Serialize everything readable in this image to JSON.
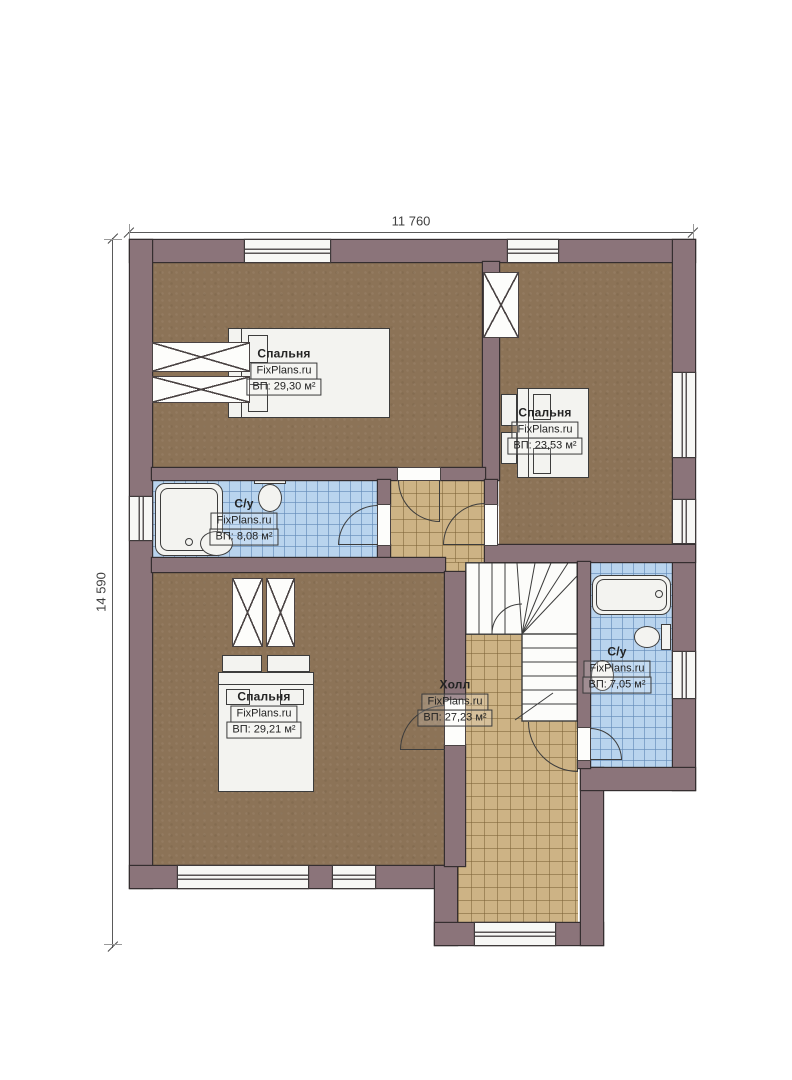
{
  "plan": {
    "type": "floor-plan",
    "watermark": "FixPlans.ru",
    "dimensions": {
      "width_label": "11 760",
      "height_label": "14 590"
    },
    "colors": {
      "wall": "#8b747a",
      "wall_outline": "#352e30",
      "carpet": "#8c7357",
      "hall_tile": "#cdb385",
      "bath_tile": "#b9d4ee",
      "paper": "#ffffff"
    }
  },
  "rooms": [
    {
      "id": "bedroom-top-left",
      "name": "Спальня",
      "brand": "FixPlans.ru",
      "area": "ВП: 29,30 м²"
    },
    {
      "id": "bedroom-top-right",
      "name": "Спальня",
      "brand": "FixPlans.ru",
      "area": "ВП: 23,53 м²"
    },
    {
      "id": "bathroom-left",
      "name": "С/у",
      "brand": "FixPlans.ru",
      "area": "ВП: 8,08 м²"
    },
    {
      "id": "bedroom-bottom-left",
      "name": "Спальня",
      "brand": "FixPlans.ru",
      "area": "ВП: 29,21 м²"
    },
    {
      "id": "hall",
      "name": "Холл",
      "brand": "FixPlans.ru",
      "area": "ВП: 27,23 м²"
    },
    {
      "id": "bathroom-right",
      "name": "С/у",
      "brand": "FixPlans.ru",
      "area": "ВП: 7,05 м²"
    }
  ]
}
